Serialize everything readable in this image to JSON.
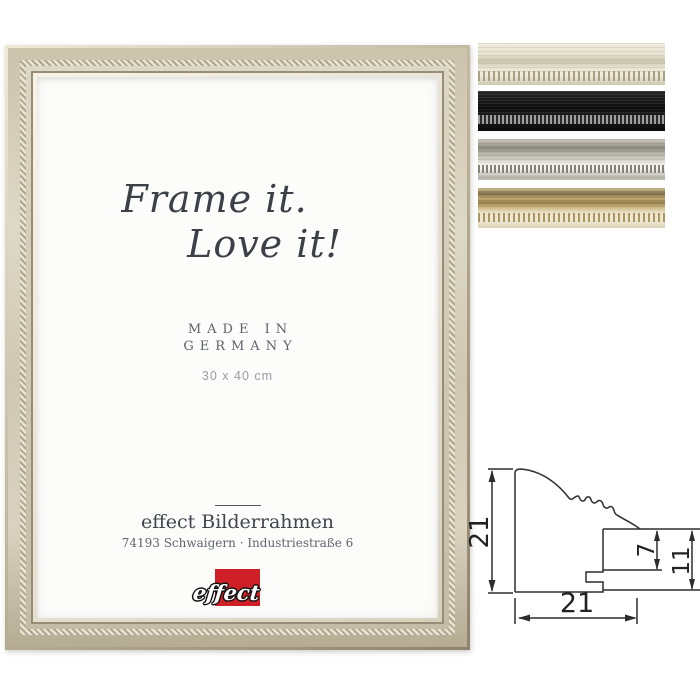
{
  "poster": {
    "headline1": "Frame it.",
    "headline2": "Love it!",
    "origin_line1": "MADE IN",
    "origin_line2": "GERMANY",
    "size": "30 x 40 cm",
    "company": "effect Bilderrahmen",
    "address": "74193 Schwaigern · Industriestraße 6",
    "logo_text": "effect",
    "logo_red": "#ce2026"
  },
  "frame": {
    "finish": "champagne-silver",
    "face": "#d6cfba",
    "bead": "#aea68d",
    "edge_light": "#efe9d9",
    "edge_dark": "#8d8370"
  },
  "swatches": [
    {
      "name": "cream-white",
      "c1": "#f1ede0",
      "c2": "#cdc7ae",
      "c3": "#e7e2d1",
      "bead": "#a9a083"
    },
    {
      "name": "black",
      "c1": "#262626",
      "c2": "#0a0a0a",
      "c3": "#1f1f1f",
      "bead": "#9d9d9d"
    },
    {
      "name": "silver-grey",
      "c1": "#cfccc2",
      "c2": "#8e8b7f",
      "c3": "#f1f0e9",
      "bead": "#85827a"
    },
    {
      "name": "gold",
      "c1": "#d8c99f",
      "c2": "#81704a",
      "c3": "#e8e1cb",
      "bead": "#ab965e"
    }
  ],
  "profile_drawing": {
    "overall_height_mm": "21",
    "rabbet_depth_mm": "7",
    "back_height_mm": "11",
    "overall_width_mm": "21",
    "line_color": "#2d2d2d"
  }
}
